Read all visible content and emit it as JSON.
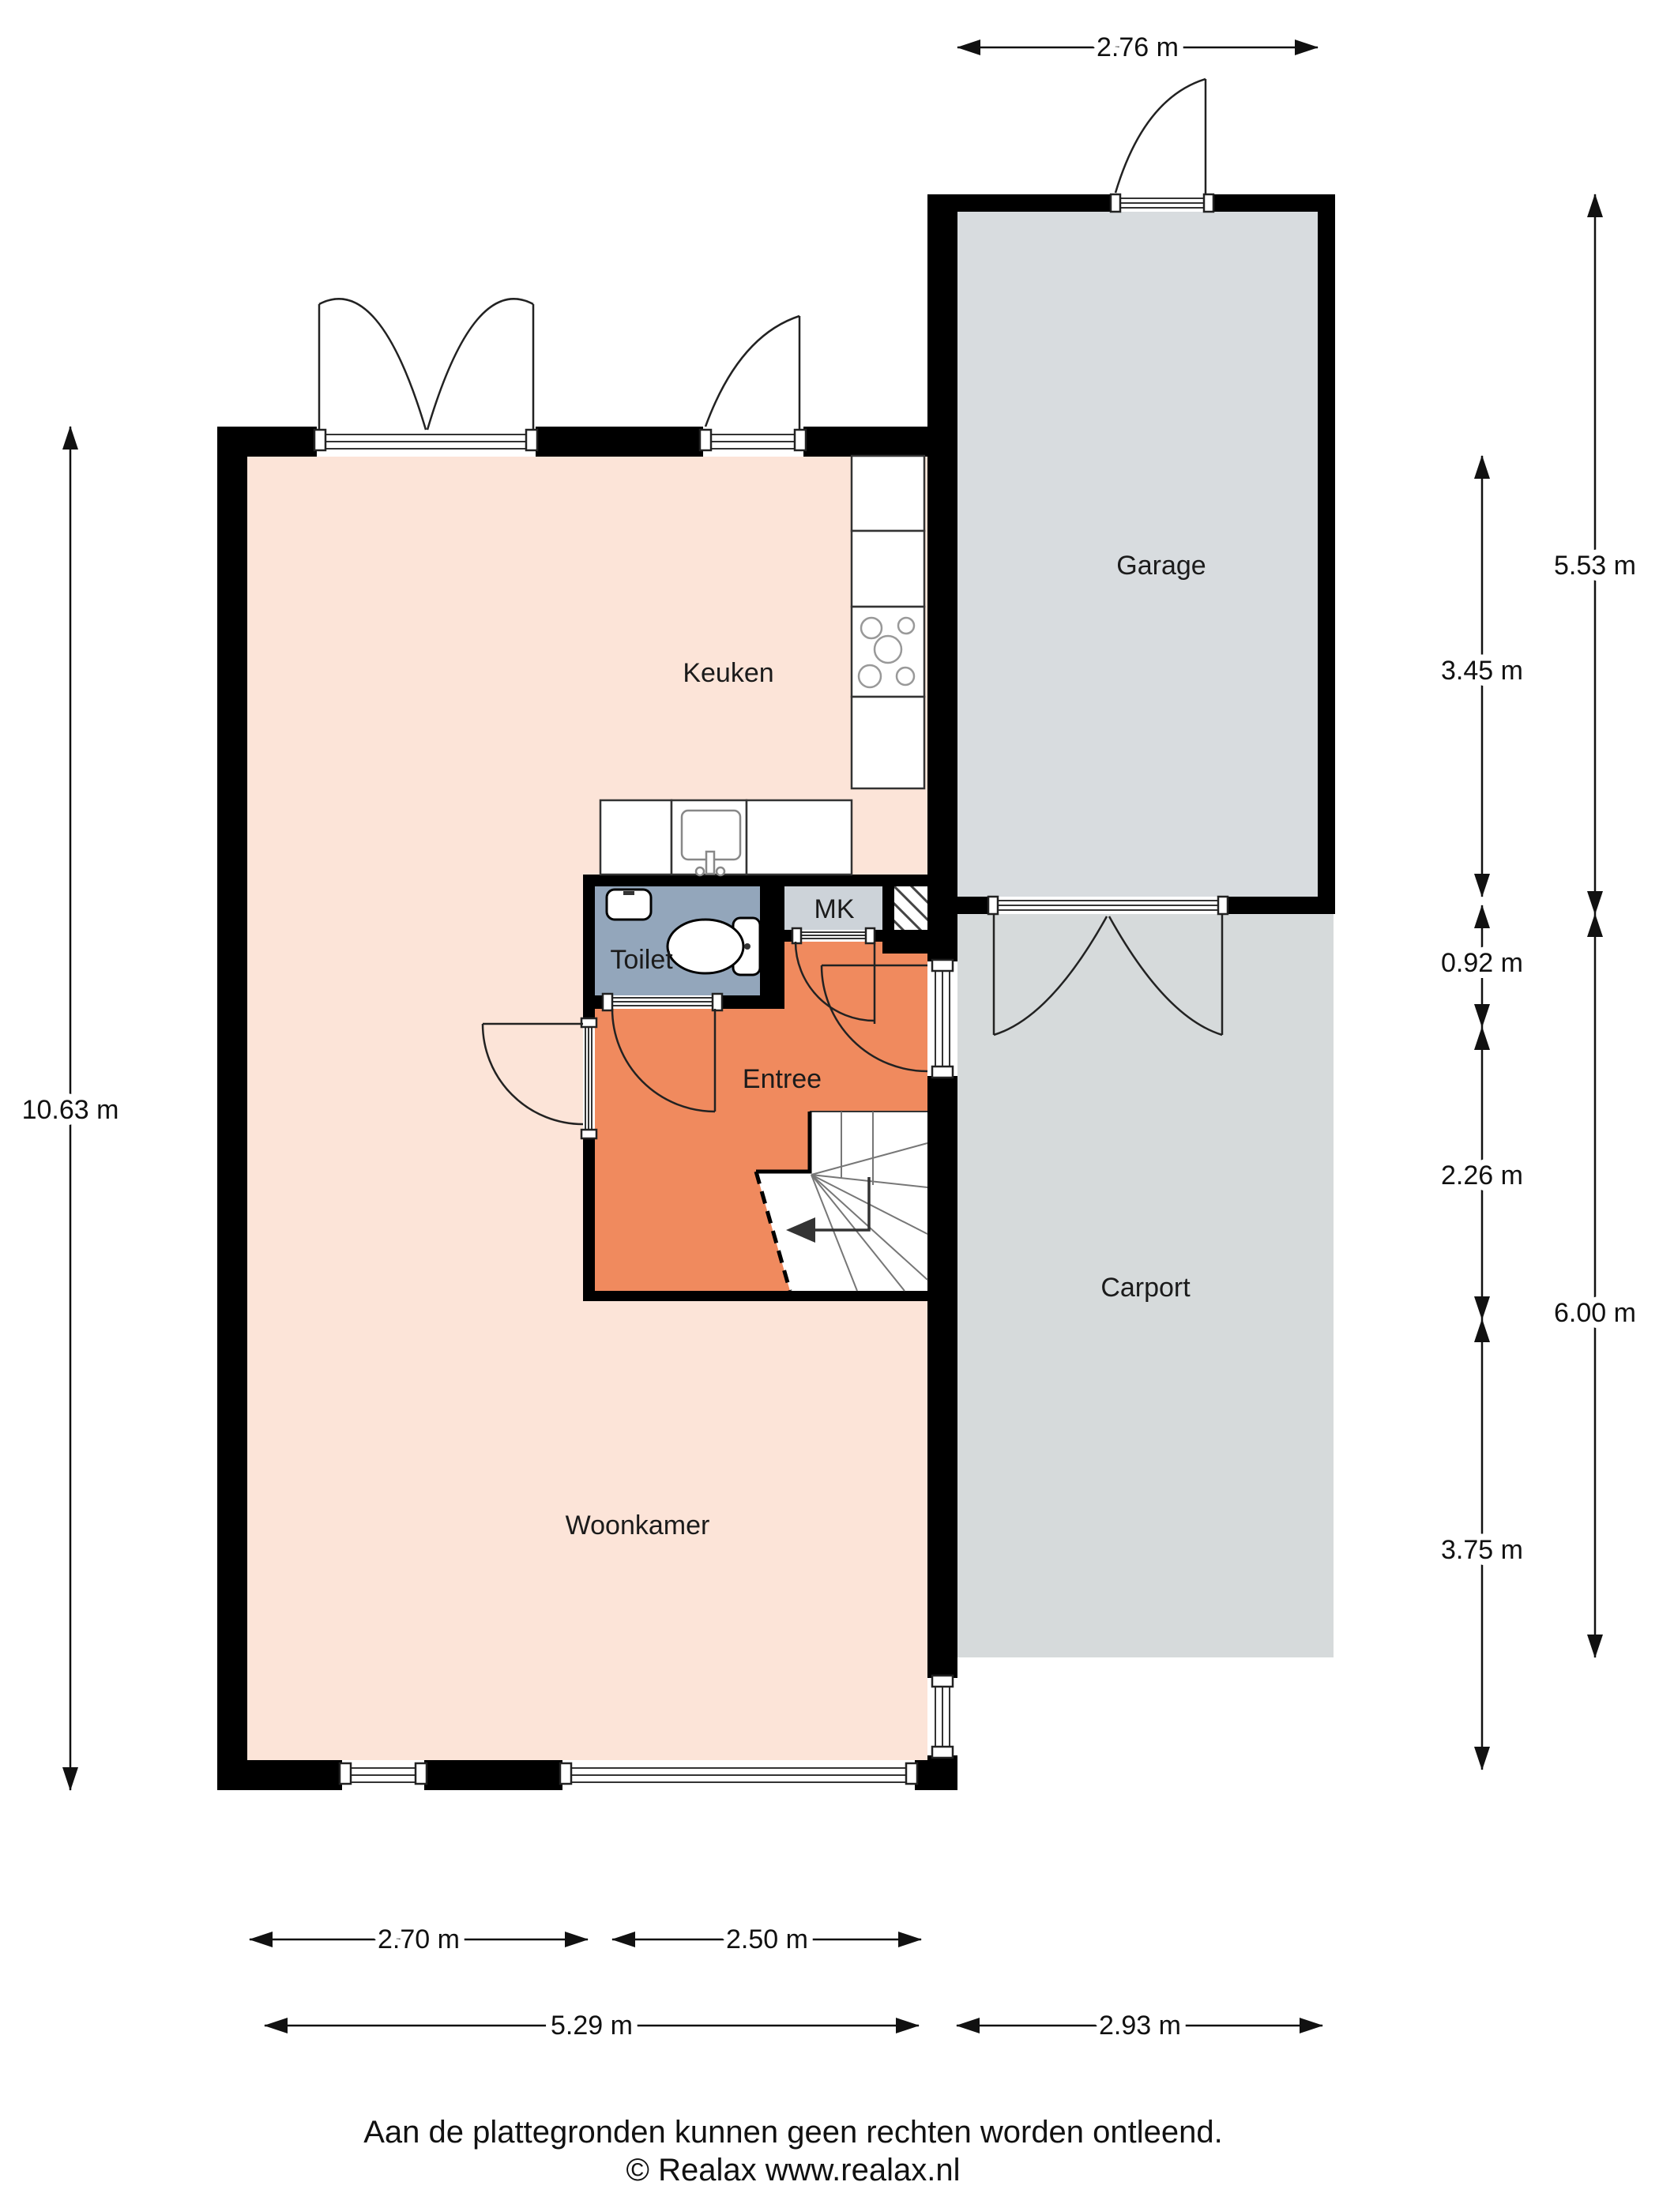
{
  "title": "Begane grond plattegrond",
  "colors": {
    "wall": "#000000",
    "living": "#fce4d8",
    "entree": "#f08a5e",
    "toilet": "#93a6bb",
    "mk": "#cdd3d9",
    "garage": "#d8dcdf",
    "carport": "#d6dadb",
    "background": "#ffffff"
  },
  "rooms": {
    "keuken": {
      "label": "Keuken"
    },
    "garage": {
      "label": "Garage"
    },
    "toilet": {
      "label": "Toilet"
    },
    "mk": {
      "label": "MK"
    },
    "entree": {
      "label": "Entree"
    },
    "woonkamer": {
      "label": "Woonkamer"
    },
    "carport": {
      "label": "Carport"
    }
  },
  "dimensions": {
    "top_garage_width": {
      "label": "2.76 m"
    },
    "left_house_height": {
      "label": "10.63 m"
    },
    "right_garage_height": {
      "label": "5.53 m"
    },
    "right_carport_height": {
      "label": "6.00 m"
    },
    "right_inner_1": {
      "label": "3.45 m"
    },
    "right_inner_2": {
      "label": "0.92 m"
    },
    "right_inner_3": {
      "label": "2.26 m"
    },
    "right_inner_4": {
      "label": "3.75 m"
    },
    "bottom_window_left": {
      "label": "2.70 m"
    },
    "bottom_window_right": {
      "label": "2.50 m"
    },
    "bottom_house_width": {
      "label": "5.29 m"
    },
    "bottom_carport_width": {
      "label": "2.93 m"
    }
  },
  "footer": {
    "line1": "Aan de plattegronden kunnen geen rechten worden ontleend.",
    "line2": "© Realax www.realax.nl"
  }
}
